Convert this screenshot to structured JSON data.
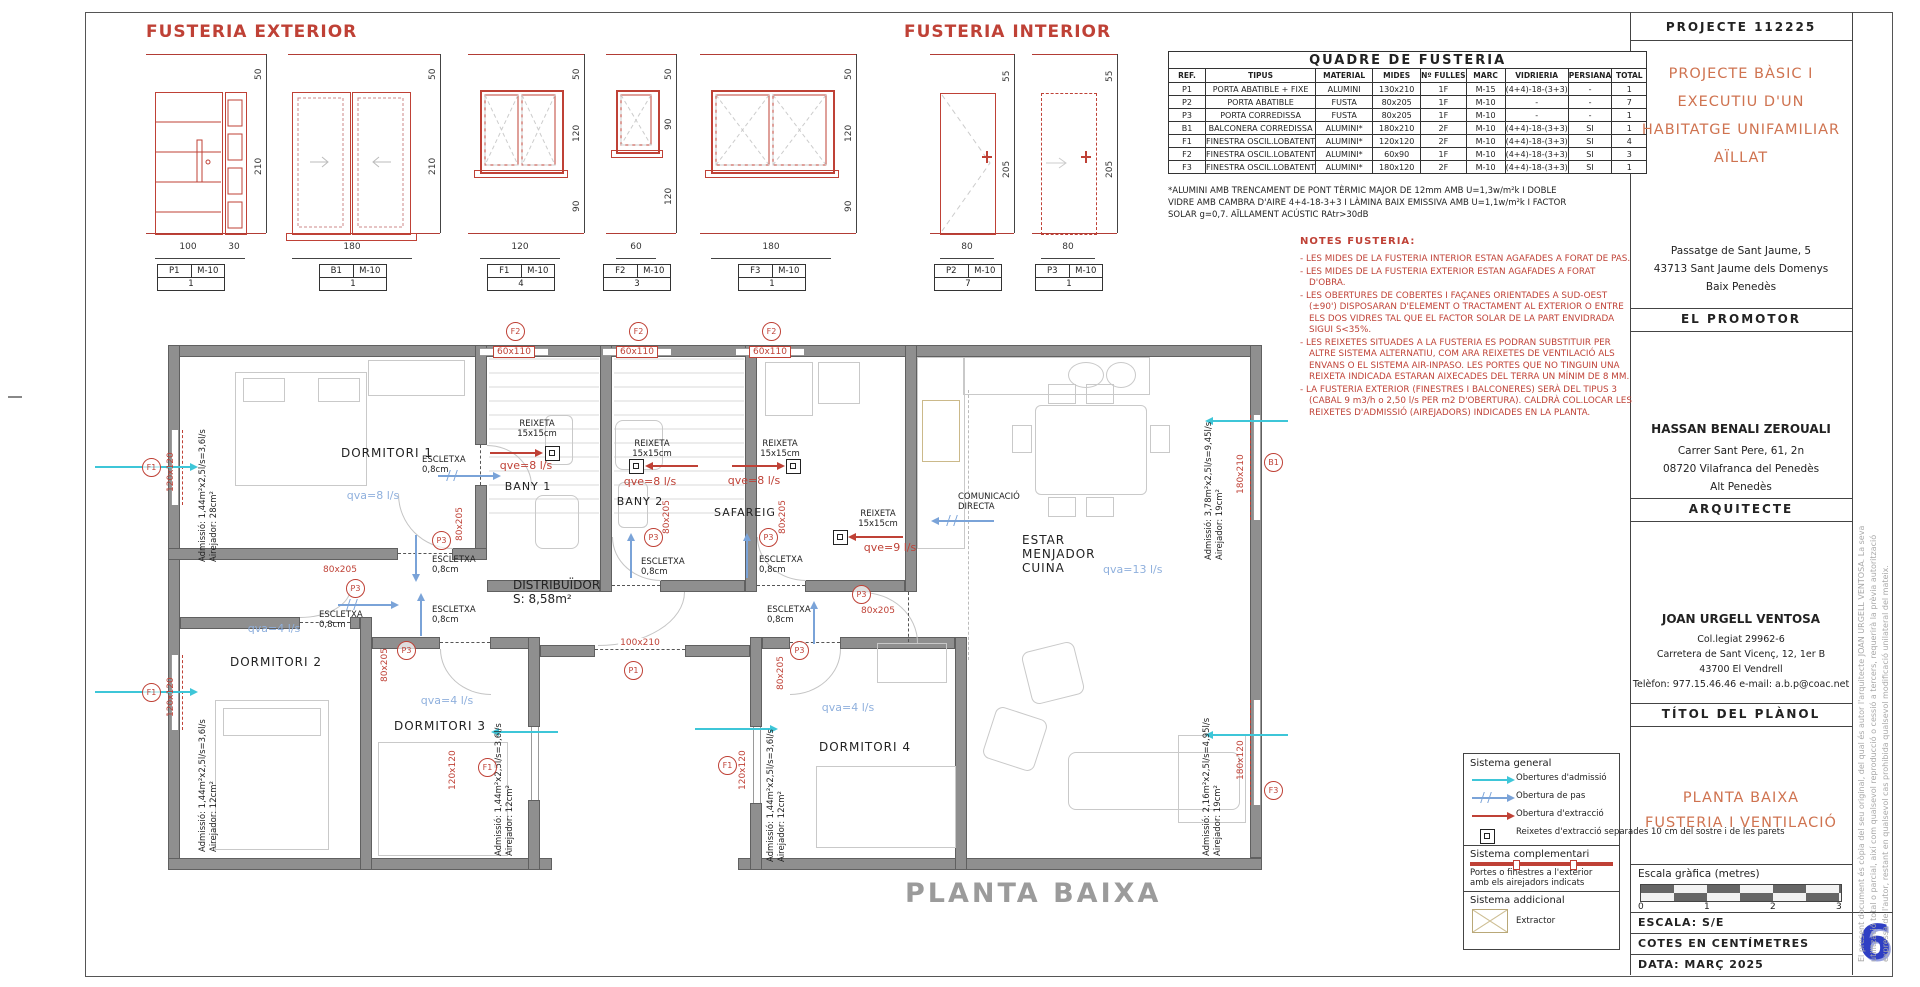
{
  "sheet": {
    "watermark": "PLANTA BAIXA"
  },
  "fx": {
    "title": "FUSTERIA EXTERIOR",
    "elev": [
      {
        "tag": "P1",
        "marc": "M-10",
        "count": "1",
        "top": "50",
        "h": "210",
        "w": "100",
        "w2": "30"
      },
      {
        "tag": "B1",
        "marc": "M-10",
        "count": "1",
        "top": "50",
        "h": "210",
        "w": "180"
      },
      {
        "tag": "F1",
        "marc": "M-10",
        "count": "4",
        "top": "50",
        "h": "120",
        "sill": "90",
        "w": "120"
      },
      {
        "tag": "F2",
        "marc": "M-10",
        "count": "3",
        "top": "50",
        "h": "90",
        "sill": "120",
        "w": "60"
      }
    ]
  },
  "fi": {
    "title": "FUSTERIA INTERIOR",
    "elev": [
      {
        "tag": "F3",
        "marc": "M-10",
        "count": "1",
        "top": "50",
        "h": "120",
        "sill": "90",
        "w": "180"
      },
      {
        "tag": "P2",
        "marc": "M-10",
        "count": "7",
        "top": "55",
        "h": "205",
        "w": "80"
      },
      {
        "tag": "P3",
        "marc": "M-10",
        "count": "1",
        "top": "55",
        "h": "205",
        "w": "80"
      }
    ]
  },
  "quadre": {
    "title": "QUADRE DE FUSTERIA",
    "headers": [
      "REF.",
      "TIPUS",
      "MATERIAL",
      "MIDES",
      "Nº FULLES",
      "MARC",
      "VIDRIERIA",
      "PERSIANA",
      "TOTAL"
    ],
    "rows": [
      [
        "P1",
        "PORTA ABATIBLE + FIXE",
        "ALUMINI",
        "130x210",
        "1F",
        "M-15",
        "(4+4)-18-(3+3)",
        "-",
        "1"
      ],
      [
        "P2",
        "PORTA ABATIBLE",
        "FUSTA",
        "80x205",
        "1F",
        "M-10",
        "-",
        "-",
        "7"
      ],
      [
        "P3",
        "PORTA CORREDISSA",
        "FUSTA",
        "80x205",
        "1F",
        "M-10",
        "-",
        "-",
        "1"
      ],
      [
        "B1",
        "BALCONERA CORREDISSA",
        "ALUMINI*",
        "180x210",
        "2F",
        "M-10",
        "(4+4)-18-(3+3)",
        "SI",
        "1"
      ],
      [
        "F1",
        "FINESTRA OSCIL.LOBATENT",
        "ALUMINI*",
        "120x120",
        "2F",
        "M-10",
        "(4+4)-18-(3+3)",
        "SI",
        "4"
      ],
      [
        "F2",
        "FINESTRA OSCIL.LOBATENT",
        "ALUMINI*",
        "60x90",
        "1F",
        "M-10",
        "(4+4)-18-(3+3)",
        "SI",
        "3"
      ],
      [
        "F3",
        "FINESTRA OSCIL.LOBATENT",
        "ALUMINI*",
        "180x120",
        "2F",
        "M-10",
        "(4+4)-18-(3+3)",
        "SI",
        "1"
      ]
    ],
    "footnote": [
      "*ALUMINI AMB TRENCAMENT DE PONT TÈRMIC MAJOR DE 12mm AMB U=1,3w/m²k I DOBLE",
      "VIDRE AMB CAMBRA D'AIRE 4+4-18-3+3 I LÀMINA BAIX EMISSIVA AMB U=1,1w/m²k I FACTOR",
      "SOLAR g=0,7. AÏLLAMENT ACÚSTIC RAtr>30dB"
    ]
  },
  "notes": {
    "title": "NOTES FUSTERIA:",
    "items": [
      "LES MIDES DE LA FUSTERIA INTERIOR ESTAN AGAFADES A FORAT DE PAS.",
      "LES MIDES DE LA FUSTERIA EXTERIOR ESTAN AGAFADES A FORAT D'OBRA.",
      "LES OBERTURES DE COBERTES I FAÇANES ORIENTADES A SUD-OEST (±90') DISPOSARAN D'ELEMENT O TRACTAMENT AL EXTERIOR O ENTRE ELS DOS VIDRES TAL QUE EL FACTOR SOLAR DE LA PART ENVIDRADA SIGUI S<35%.",
      "LES REIXETES SITUADES A LA FUSTERIA ES PODRAN SUBSTITUIR PER ALTRE SISTEMA ALTERNATIU, COM ARA REIXETES DE VENTILACIÓ ALS ENVANS O EL SISTEMA AIR-INPASO. LES PORTES QUE NO TINGUIN UNA REIXETA INDICADA ESTARAN AIXECADES DEL TERRA UN MÍNIM DE 8 MM.",
      "LA FUSTERIA EXTERIOR (FINESTRES I BALCONERES) SERÀ DEL TIPUS 3 (CABAL 9 m3/h o 2,50 l/s PER m2 D'OBERTURA). CALDRÀ COL.LOCAR LES REIXETES D'ADMISSIÓ (AIREJADORS) INDICADES EN LA PLANTA."
    ]
  },
  "plan": {
    "rooms": {
      "dormitori1": "DORMITORI 1",
      "dormitori2": "DORMITORI 2",
      "dormitori3": "DORMITORI 3",
      "dormitori4": "DORMITORI 4",
      "bany1": "BANY 1",
      "bany2": "BANY 2",
      "safareig": "SAFAREIG",
      "estar": [
        "ESTAR",
        "MENJADOR",
        "CUINA"
      ],
      "distribuidor": [
        "DISTRIBUÏDOR",
        "S: 8,58m²"
      ]
    },
    "qva": {
      "dormitori1": "qva=8 l/s",
      "dormitori2": "qva=4 l/s",
      "dormitori3": "qva=4 l/s",
      "dormitori4": "qva=4 l/s",
      "estar": "qva=13 l/s"
    },
    "qve": {
      "bany1": "qve=8 l/s",
      "bany2": "qve=8 l/s",
      "safareig": "qve=8 l/s",
      "cuina": "qve=9 l/s"
    },
    "reixeta": [
      "REIXETA",
      "15x15cm"
    ],
    "escletxa": [
      "ESCLETXA",
      "0,8cm"
    ],
    "comunicacio": [
      "COMUNICACIÓ",
      "DIRECTA"
    ],
    "admissio": {
      "dormitori1": [
        "Admissió: 1,44m²x2,5l/s=3,6l/s",
        "Airejador: 28cm²"
      ],
      "dormitori2": [
        "Admissió: 1,44m²x2,5l/s=3,6l/s",
        "Airejador: 12cm²"
      ],
      "dormitori3": [
        "Admissió: 1,44m²x2,5l/s=3,6l/s",
        "Airejador: 12cm²"
      ],
      "dormitori4": [
        "Admissió: 1,44m²x2,5l/s=3,6l/s",
        "Airejador: 12cm²"
      ],
      "estar_nord": [
        "Admissió: 3,78m²x2,5l/s=9,45l/s",
        "Airejador: 19cm²"
      ],
      "estar_sud": [
        "Admissió: 2,16m²x2,5l/s=4,95l/s",
        "Airejador: 19cm²"
      ]
    },
    "tags": {
      "p1": "P1",
      "p3": "P3",
      "b1": "B1",
      "f1": "F1",
      "f2": "F2",
      "f3": "F3"
    },
    "sizes": {
      "s60110": "60x110",
      "s120120": "120x120",
      "s180210": "180x210",
      "s180120": "180x120",
      "s80205": "80x205",
      "s100210": "100x210"
    }
  },
  "legend": {
    "general": {
      "title": "Sistema general",
      "items": [
        {
          "icon": "admission-arrow",
          "label": "Obertures d'admissió"
        },
        {
          "icon": "pas-arrow",
          "label": "Obertura de pas"
        },
        {
          "icon": "extraction-arrow",
          "label": "Obertura d'extracció"
        },
        {
          "icon": "reixeta-square",
          "label": "Reixetes d'extracció separades 10 cm del sostre i de les parets"
        }
      ]
    },
    "complementari": {
      "title": "Sistema complementari",
      "text": "Portes o finestres a l'exterior amb els airejadors indicats"
    },
    "addicional": {
      "title": "Sistema addicional",
      "label": "Extractor"
    }
  },
  "titleblock": {
    "projecte": "PROJECTE  112225",
    "title_lines": [
      "PROJECTE  BÀSIC  I",
      "EXECUTIU  D'UN",
      "HABITATGE  UNIFAMILIAR",
      "AÏLLAT"
    ],
    "address_lines": [
      "Passatge de Sant Jaume, 5",
      "43713 Sant Jaume dels Domenys",
      "Baix Penedès"
    ],
    "promotor": "EL PROMOTOR",
    "promotor_name": "HASSAN  BENALI  ZEROUALI",
    "promotor_lines": [
      "Carrer Sant Pere, 61, 2n",
      "08720 Vilafranca del Penedès",
      "Alt Penedès"
    ],
    "arquitecte": "ARQUITECTE",
    "arquitecte_name": "JOAN  URGELL  VENTOSA",
    "arquitecte_lines": [
      "Col.legiat 29962-6",
      "Carretera de Sant Vicenç, 12, 1er B",
      "43700 El Vendrell",
      "Telèfon: 977.15.46.46   e-mail: a.b.p@coac.net"
    ],
    "titol": "TÍTOL DEL PLÀNOL",
    "plan_title": [
      "PLANTA BAIXA",
      "FUSTERIA I VENTILACIÓ"
    ],
    "escala_grafica": "Escala gràfica (metres)",
    "ticks": [
      "0",
      "1",
      "2",
      "3"
    ],
    "escala": "ESCALA: S/E",
    "cotes": "COTES EN CENTÍMETRES",
    "data": "DATA: MARÇ 2025",
    "num": "6",
    "disclaimer": [
      "El present document és còpia del seu original, del qual és autor l'arquitecte JOAN URGELL VENTOSA. La seva",
      "utilització total o parcial, així com qualsevol reproducció o cessió a tercers, requerirà la prèvia autorització",
      "expressa de l'autor, restant en qualsevol cas prohibida qualsevol modificació unilateral del mateix."
    ]
  }
}
